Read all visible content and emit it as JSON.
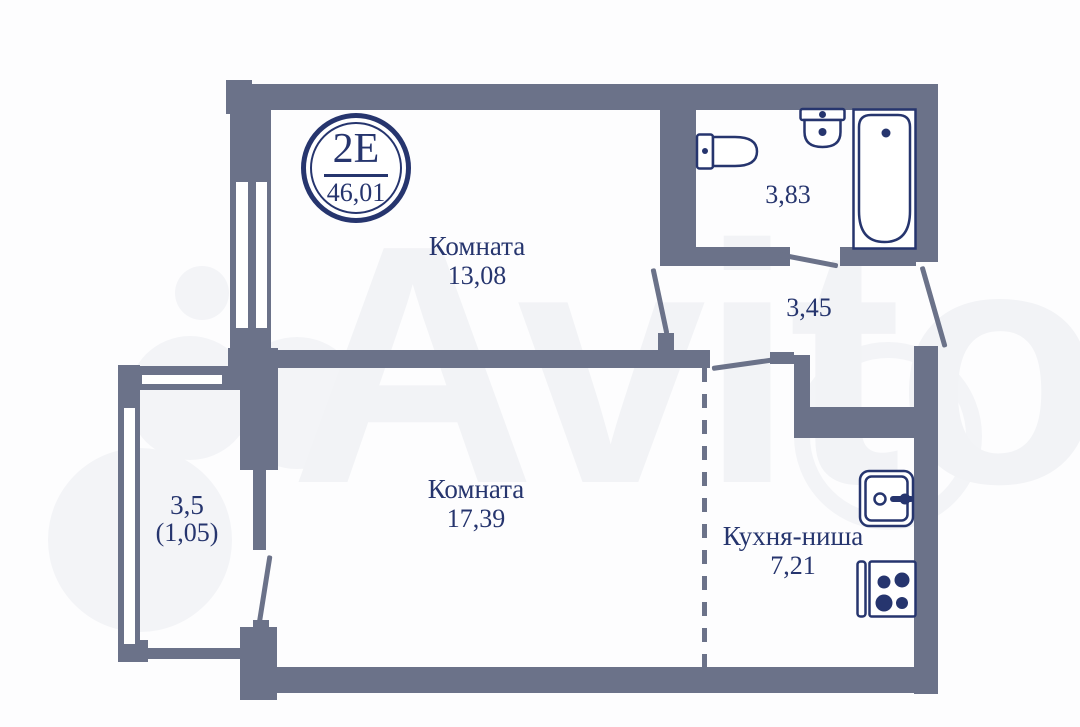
{
  "badge": {
    "unit_type": "2Е",
    "total_area": "46,01"
  },
  "rooms": {
    "room_top": {
      "label": "Комната",
      "area": "13,08"
    },
    "room_main": {
      "label": "Комната",
      "area": "17,39"
    },
    "kitchen": {
      "label": "Кухня-ниша",
      "area": "7,21"
    },
    "bathroom": {
      "area": "3,83"
    },
    "hallway": {
      "area": "3,45"
    },
    "balcony": {
      "area": "3,5",
      "area_coefficient": "(1,05)"
    }
  },
  "watermark": {
    "text": "Avito"
  },
  "colors": {
    "wall": "#6b7289",
    "line_accent": "#26356e",
    "watermark": "#f2f3f6"
  }
}
